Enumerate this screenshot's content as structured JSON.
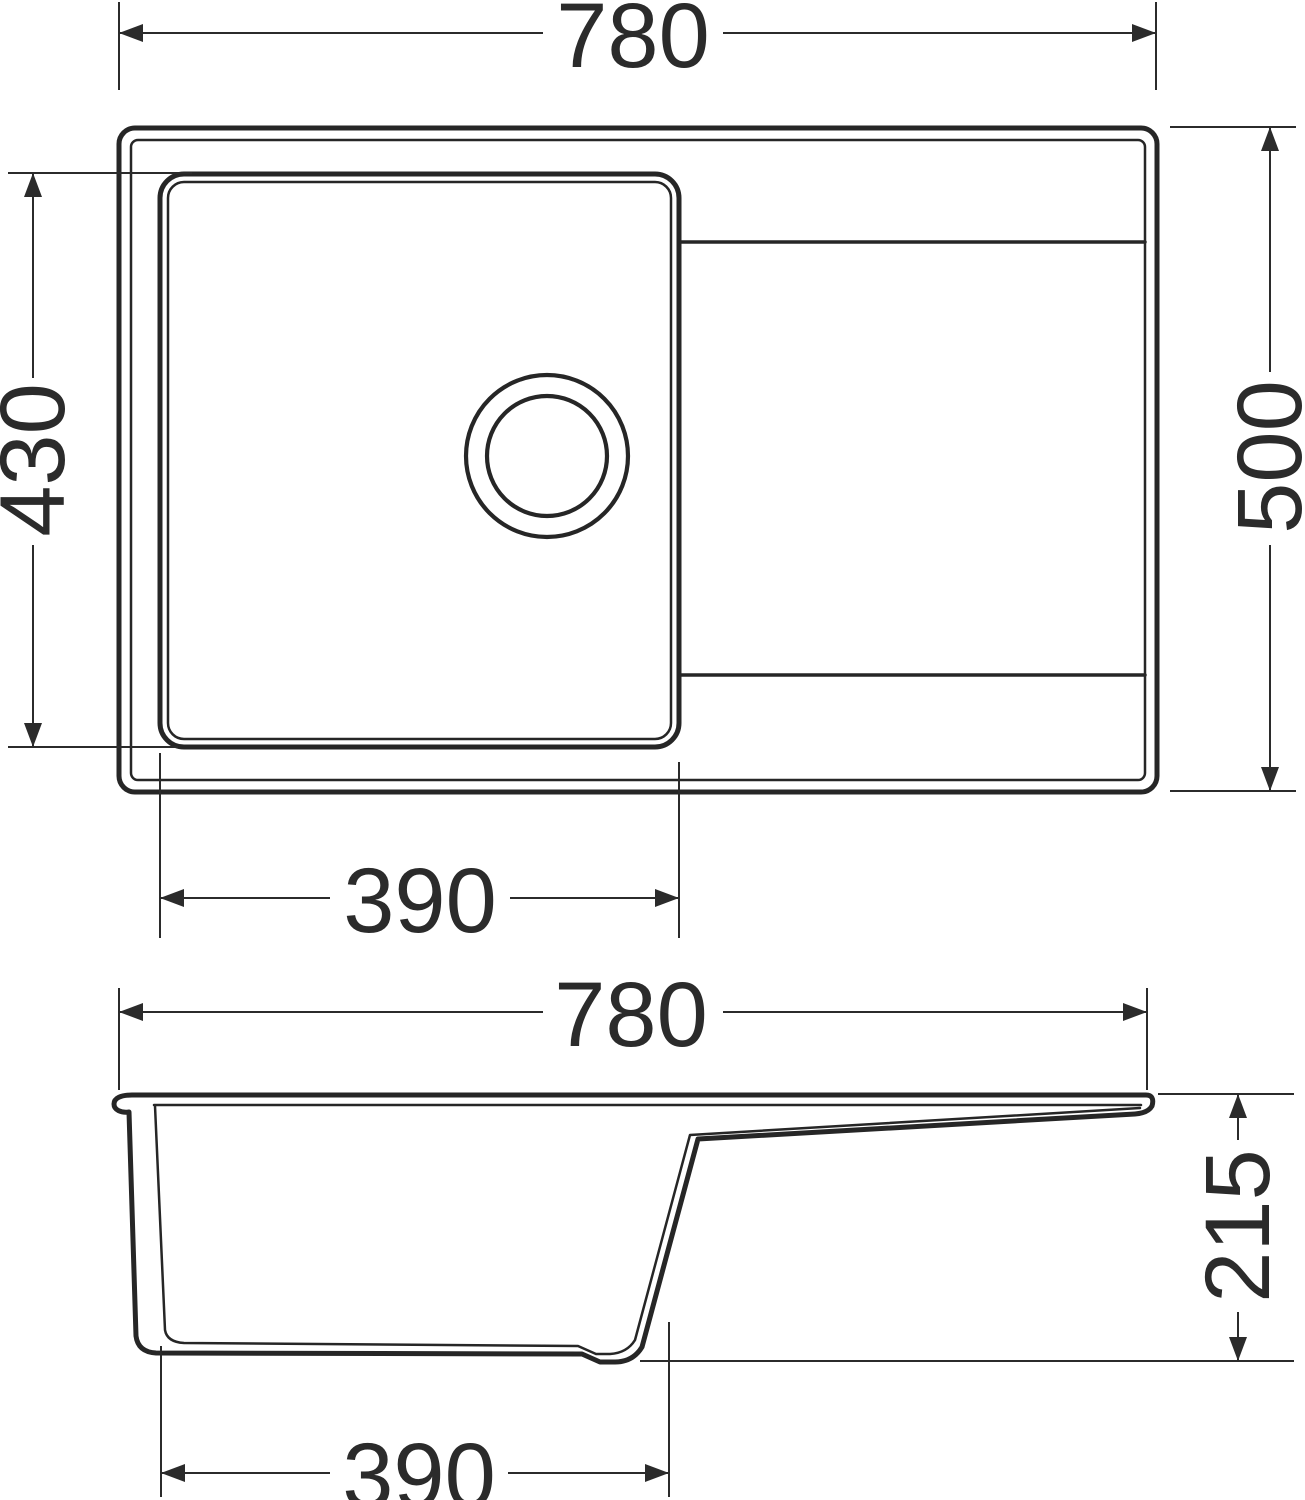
{
  "colors": {
    "line": "#262626",
    "dimension": "#2b2b2b",
    "background": "#ffffff"
  },
  "views": {
    "top": {
      "dims": {
        "overall_width": "780",
        "bowl_front_to_back": "430",
        "overall_depth": "500",
        "bowl_width": "390"
      }
    },
    "side": {
      "dims": {
        "overall_width": "780",
        "overall_height": "215",
        "bowl_width": "390"
      }
    }
  }
}
